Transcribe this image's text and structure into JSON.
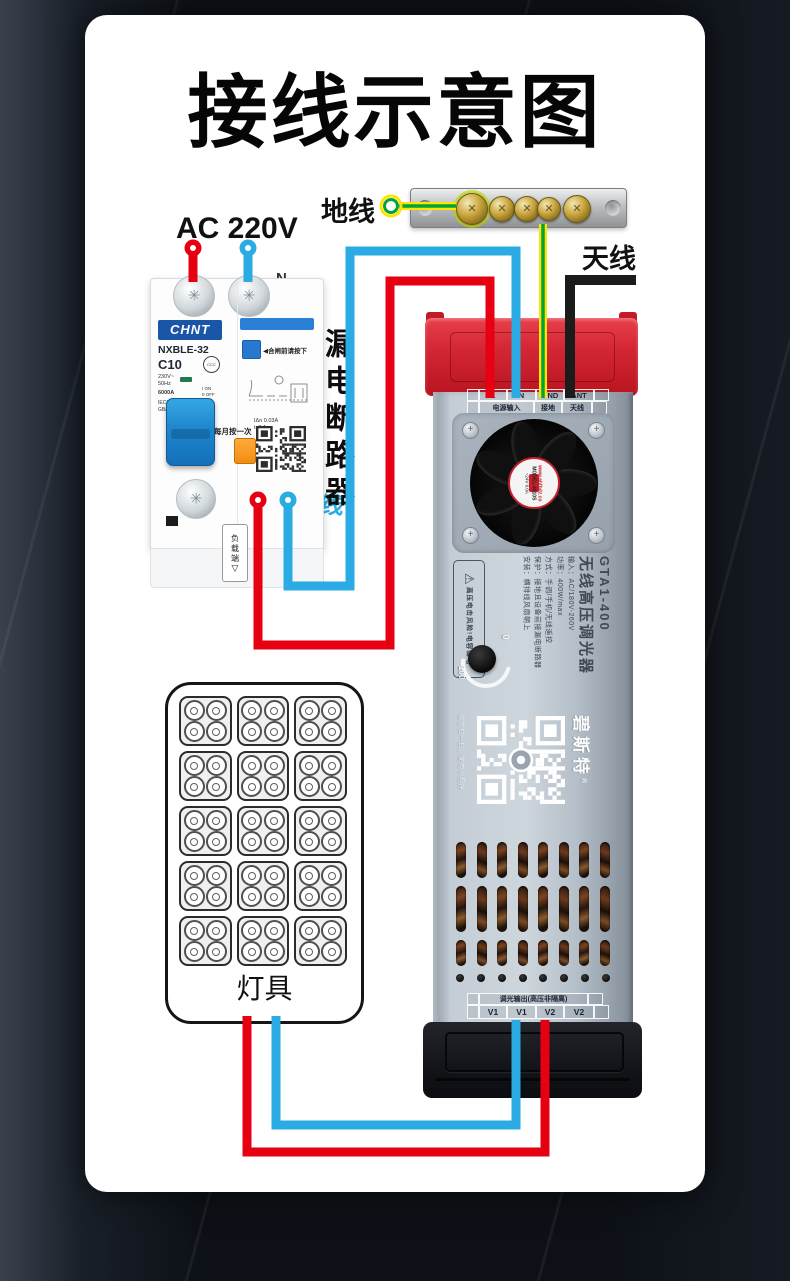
{
  "title": "接线示意图",
  "labels": {
    "ac": "AC 220V",
    "ground": "地线",
    "antenna": "天线",
    "live": "火线",
    "neutral": "零线",
    "breakerSide": "漏电断路器",
    "nTop": "N",
    "nBottom": "N",
    "arrow": "→"
  },
  "breaker": {
    "brand": "CHNT",
    "model": "NXBLE-32",
    "rating": "C10",
    "volt": "230V~",
    "freq": "50Hz",
    "breakCap": "6000A",
    "onLabel": "I ON",
    "offLabel": "0 OFF",
    "std1": "IEC61009-1",
    "std2": "GB/T 16917.1",
    "ccc": "CCC",
    "pressNote": "◀合闸前请按下",
    "idn": "IΔn 0.03A",
    "trip": "t≤0.1s",
    "monthly": "每月按一次",
    "loadSide": "负载端",
    "loadArrow": "▽"
  },
  "groundBar": {
    "screwsX": [
      60,
      90,
      115,
      137,
      165
    ],
    "screwSizes": [
      30,
      24,
      24,
      22,
      26
    ],
    "groundedScrew": 0,
    "holesX": [
      14,
      202
    ]
  },
  "device": {
    "top": {
      "cells": [
        "",
        "L",
        "N",
        "GND",
        "ANT",
        ""
      ],
      "cellW": [
        10,
        26,
        27,
        26,
        28,
        13
      ],
      "groups": [
        "",
        "电源输入",
        "接地",
        "天线",
        ""
      ],
      "groupW": [
        10,
        53,
        26,
        28,
        13
      ]
    },
    "fanSticker": {
      "site": "www.ahfbdz.co",
      "model": "MODEL-4010S",
      "rating": "~24V 0.0A"
    },
    "side": {
      "model": "GTA1-400",
      "name": "无线高压调光器",
      "specs": [
        "输入：AC/180V-260V",
        "功率：400W/max",
        "方式：手调/手机/无线遥控",
        "保护：接地且设备前接漏电断路器",
        "安装：横排线风扇朝上"
      ]
    },
    "warning": {
      "icon": "⚠",
      "line1": "高压电击风险",
      "line2": "!电容储电"
    },
    "knob": {
      "min": "0",
      "max": "100"
    },
    "qrBrand": "碧斯特",
    "qrReg": "®",
    "qrHint": "微信扫一扫，使用小程序",
    "out": {
      "title": "调光输出(高压非隔离)",
      "titleW": [
        10,
        107,
        13
      ],
      "cells": [
        "",
        "V1",
        "V1",
        "V2",
        "V2",
        ""
      ],
      "cellW": [
        10,
        26,
        27,
        26,
        28,
        13
      ]
    }
  },
  "lampPanel": {
    "label": "灯具",
    "rows": 5,
    "cols": 3,
    "lampsPerModule": 4
  },
  "colors": {
    "live": "#e60012",
    "neutral": "#2aabe4",
    "groundYellow": "#ffe400",
    "groundGreen": "#00a33c",
    "antenna": "#1b1b1b"
  },
  "wires": [
    {
      "name": "live-input-stub",
      "color": "#e60012",
      "w": 9,
      "pts": "193,254 193,282"
    },
    {
      "name": "neutral-input-stub",
      "color": "#2aabe4",
      "w": 9,
      "pts": "248,254 248,282"
    },
    {
      "name": "live-link-wire",
      "color": "#e60012",
      "w": 9,
      "pts": "258,505 258,645 390,645 390,281 490,281 490,398"
    },
    {
      "name": "neutral-link-wire",
      "color": "#2aabe4",
      "w": 9,
      "pts": "288,505 288,586 350,586 350,251 516,251 516,398"
    },
    {
      "name": "ground-wire-h-outer",
      "color": "#ffe400",
      "w": 8,
      "pts": "399,206 456,206"
    },
    {
      "name": "ground-wire-h-core",
      "color": "#00a33c",
      "w": 3.5,
      "pts": "399,206 456,206"
    },
    {
      "name": "ground-wire-v-outer",
      "color": "#ffe400",
      "w": 8,
      "pts": "543,224 543,398"
    },
    {
      "name": "ground-wire-v-core",
      "color": "#00a33c",
      "w": 3.5,
      "pts": "543,224 543,398"
    },
    {
      "name": "antenna-wire",
      "color": "#1b1b1b",
      "w": 10,
      "pts": "636,280 570,280 570,398"
    },
    {
      "name": "output-neutral-wire",
      "color": "#2aabe4",
      "w": 9,
      "pts": "516,1020 516,1125 276,1125 276,1016"
    },
    {
      "name": "output-live-wire",
      "color": "#e60012",
      "w": 9,
      "pts": "545,1020 545,1152 247,1152 247,1016"
    }
  ],
  "dots": [
    {
      "name": "live-input-pin",
      "x": 193,
      "y": 248,
      "c": "#e60012",
      "t": "pin"
    },
    {
      "name": "neutral-input-pin",
      "x": 248,
      "y": 248,
      "c": "#2aabe4",
      "t": "pin"
    },
    {
      "name": "live-output-pin",
      "x": 258,
      "y": 500,
      "c": "#e60012",
      "t": "pin"
    },
    {
      "name": "neutral-output-pin",
      "x": 288,
      "y": 500,
      "c": "#2aabe4",
      "t": "pin"
    },
    {
      "name": "ground-ring",
      "x": 391,
      "y": 206,
      "c": "#00a33c",
      "t": "ring"
    }
  ]
}
